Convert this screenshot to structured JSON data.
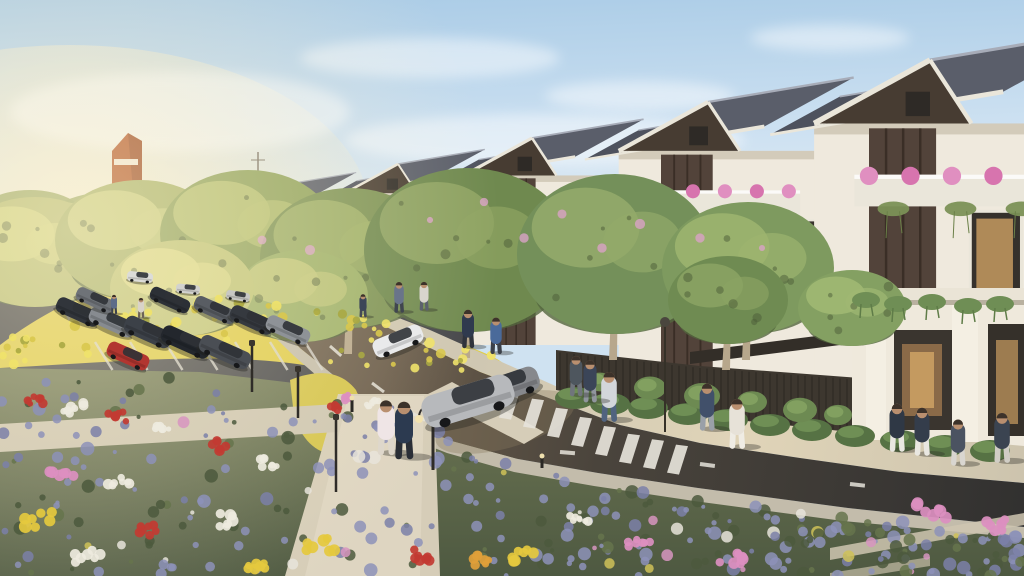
{
  "scene": {
    "description": "Photorealistic architectural rendering of a new residential neighborhood: a receding row of modern gabled townhouses with pink balcony flowers, tree-lined street with cars and pedestrians, parking lot, yellow flower bushes and a lavender flower garden in the foreground, late-afternoon sunlight from the left.",
    "type": "architectural-render"
  },
  "palette": {
    "sky_top": "#a9cbe6",
    "sky_mid": "#cfe2f2",
    "sky_low": "#eef2f0",
    "sun_glow": "#fbf3da",
    "roof": "#5a5e6a",
    "roof_dark": "#4e525e",
    "roof_line": "#a7acb8",
    "fascia": "#eae6da",
    "gable": "#473c32",
    "wall": "#efe9dd",
    "wall_shade": "#c9c0ae",
    "wood": "#52433a",
    "wood_dark": "#3a2e26",
    "glass": "#35312c",
    "glass_warm": "#c49a60",
    "balcony_pink": "#e08fc0",
    "pink_deep": "#d774ae",
    "vine": "#7b9156",
    "vine_dark": "#6b8048",
    "flower_yellow": "#dfcc48",
    "yellow_hi": "#f0e26a",
    "yellow_dk": "#aaa844",
    "lavender": "#8d92b8",
    "lavender_hi": "#a7abc9",
    "garden_dark": "#4c593d",
    "garden_mid": "#5d6b48",
    "road_warm": "#6a5c4b",
    "road_mid": "#4a443c",
    "road_dark": "#323130",
    "lot_asphalt": "#45464a",
    "marking": "#e6e3da",
    "path": "#d6cdb8",
    "path_hi": "#e2dac6",
    "sidewalk": "#c3bcab",
    "plaza": "#d4ccb8",
    "plaza_sun": "#e0d4b8",
    "fence": "#3d372f",
    "pergola": "#332e28",
    "hedge": "#567244",
    "hedge_hi": "#6f8f55",
    "orange_tower": "#b4582a",
    "orange_dark": "#8a3f1e",
    "trunk": "#b7a78c",
    "skin": "#b98f6f",
    "shadow": "#2c2a26",
    "blossom": "#d9a3c6"
  },
  "clouds": [
    [
      430,
      58,
      130,
      20
    ],
    [
      640,
      96,
      95,
      15
    ],
    [
      830,
      38,
      80,
      13
    ],
    [
      180,
      112,
      170,
      40
    ],
    [
      545,
      140,
      200,
      26
    ]
  ],
  "orange_tower": {
    "x": 112,
    "y": 133,
    "w": 30,
    "h": 68
  },
  "distant_houses": [
    [
      62,
      206,
      13
    ],
    [
      86,
      202,
      14
    ],
    [
      111,
      198,
      15
    ],
    [
      137,
      194,
      16
    ],
    [
      165,
      190,
      17
    ],
    [
      195,
      186,
      18
    ]
  ],
  "houses": [
    [
      225,
      197,
      34,
      278
    ],
    [
      288,
      184,
      44,
      295
    ],
    [
      398,
      164,
      56,
      315
    ],
    [
      532,
      138,
      72,
      345
    ],
    [
      708,
      102,
      94,
      402
    ],
    [
      930,
      60,
      122,
      448
    ]
  ],
  "trees": [
    [
      35,
      252,
      78,
      55,
      "#b9bf74",
      "#d3d583",
      0
    ],
    [
      140,
      240,
      85,
      60,
      "#a9b46a",
      "#ccd083",
      0
    ],
    [
      248,
      234,
      88,
      64,
      "#90a35c",
      "#b8c273",
      0
    ],
    [
      350,
      258,
      90,
      70,
      "#7d9355",
      "#9fb068",
      1
    ],
    [
      468,
      250,
      104,
      82,
      "#6f894f",
      "#8fa463",
      1
    ],
    [
      615,
      254,
      98,
      80,
      "#74905a",
      "#93aa6a",
      1
    ],
    [
      748,
      268,
      86,
      66,
      "#7e9a5f",
      "#9cb46f",
      1
    ],
    [
      852,
      308,
      54,
      38,
      "#84a062",
      "#a0b873",
      0
    ],
    [
      302,
      296,
      66,
      46,
      "#9cb067",
      "#c2c87a",
      0
    ],
    [
      182,
      288,
      72,
      48,
      "#c0c577",
      "#ddda8a",
      0
    ],
    [
      728,
      300,
      60,
      44,
      "#6f8b52",
      "#8aa263",
      1
    ]
  ],
  "blossoms": [
    [
      430,
      220
    ],
    [
      484,
      202
    ],
    [
      524,
      238
    ],
    [
      562,
      214
    ],
    [
      640,
      224
    ],
    [
      602,
      248
    ],
    [
      700,
      238
    ],
    [
      762,
      248
    ],
    [
      310,
      250
    ],
    [
      262,
      240
    ]
  ],
  "cars_road": [
    [
      398,
      341,
      52,
      19,
      -22,
      "#e9eaeb"
    ],
    [
      509,
      386,
      62,
      25,
      -19,
      "#86888c"
    ],
    [
      468,
      401,
      94,
      33,
      -17,
      "#b7b9bc"
    ]
  ],
  "cars_parked": [
    [
      78,
      312,
      46,
      16,
      24,
      "#31353b"
    ],
    [
      112,
      322,
      48,
      17,
      24,
      "#878b90"
    ],
    [
      148,
      332,
      50,
      18,
      24,
      "#3c4148"
    ],
    [
      186,
      342,
      52,
      18,
      24,
      "#23272d"
    ],
    [
      225,
      352,
      54,
      18,
      24,
      "#4a4e54"
    ],
    [
      128,
      356,
      44,
      16,
      24,
      "#b23630"
    ],
    [
      95,
      300,
      40,
      14,
      24,
      "#6f7378"
    ],
    [
      170,
      300,
      42,
      14,
      24,
      "#2c3036"
    ],
    [
      215,
      310,
      44,
      15,
      24,
      "#595d63"
    ],
    [
      252,
      320,
      46,
      16,
      24,
      "#35393f"
    ],
    [
      288,
      330,
      46,
      16,
      24,
      "#8e9297"
    ],
    [
      140,
      277,
      26,
      10,
      6,
      "#dcdcd8"
    ],
    [
      188,
      289,
      24,
      9,
      6,
      "#d2d2cf"
    ],
    [
      238,
      296,
      24,
      9,
      10,
      "#c8c8c4"
    ]
  ],
  "people": [
    [
      114,
      313,
      20,
      "#5d6c88",
      "#3c414c"
    ],
    [
      141,
      317,
      21,
      "#d9d3c9",
      "#6d6257"
    ],
    [
      386,
      452,
      57,
      "#efe5e6",
      "#ded7cb"
    ],
    [
      404,
      456,
      60,
      "#2c3a50",
      "#2a2e36"
    ],
    [
      609,
      419,
      52,
      "#d3d6da",
      "#50637f"
    ],
    [
      707,
      428,
      49,
      "#41506a",
      "#9aa0a8"
    ],
    [
      737,
      446,
      52,
      "#e7e2d8",
      "#efece4"
    ],
    [
      399,
      311,
      32,
      "#69748a",
      "#40464f"
    ],
    [
      424,
      309,
      30,
      "#d9d5cd",
      "#5c616c"
    ],
    [
      468,
      346,
      40,
      "#2f3a4e",
      "#30343c"
    ],
    [
      496,
      352,
      38,
      "#4a6a9a",
      "#3b4049"
    ],
    [
      590,
      400,
      44,
      "#3b4558",
      "#90959d"
    ],
    [
      897,
      449,
      50,
      "#2f3845",
      "#e9e7e1"
    ],
    [
      922,
      453,
      50,
      "#343d4b",
      "#e9e7e1"
    ],
    [
      958,
      463,
      48,
      "#4b5361",
      "#d9d6d0"
    ],
    [
      1002,
      460,
      52,
      "#3b4451",
      "#d0cdc5"
    ],
    [
      363,
      316,
      24,
      "#3c4658",
      "#454a55"
    ],
    [
      576,
      394,
      42,
      "#4e565e",
      "#70757c"
    ]
  ],
  "lamps": [
    [
      "post",
      336,
      492,
      72
    ],
    [
      "twin",
      433,
      470,
      60
    ],
    [
      "sign",
      665,
      432,
      106
    ],
    [
      "post",
      252,
      392,
      46
    ],
    [
      "post",
      298,
      418,
      46
    ],
    [
      "bollard",
      352,
      412,
      14
    ],
    [
      "bollard",
      542,
      468,
      12
    ]
  ],
  "hedges": [
    [
      575,
      398
    ],
    [
      610,
      404
    ],
    [
      648,
      408
    ],
    [
      688,
      414
    ],
    [
      728,
      420
    ],
    [
      770,
      425
    ],
    [
      812,
      430
    ],
    [
      855,
      436
    ],
    [
      900,
      441
    ],
    [
      945,
      446
    ],
    [
      990,
      451
    ]
  ],
  "fence_vines": [
    [
      600,
      382,
      13
    ],
    [
      650,
      388,
      16
    ],
    [
      702,
      396,
      18
    ],
    [
      752,
      402,
      15
    ],
    [
      800,
      410,
      17
    ],
    [
      838,
      415,
      14
    ]
  ],
  "hanging_plants": [
    [
      866,
      300
    ],
    [
      898,
      304
    ],
    [
      932,
      302
    ],
    [
      968,
      306
    ],
    [
      1000,
      304
    ]
  ],
  "flower_clusters": [
    [
      35,
      400,
      10,
      "#c23b32"
    ],
    [
      75,
      408,
      12,
      "#eeeade"
    ],
    [
      118,
      416,
      11,
      "#c23b32"
    ],
    [
      160,
      430,
      9,
      "#eeeade"
    ],
    [
      215,
      446,
      12,
      "#c23b32"
    ],
    [
      268,
      462,
      10,
      "#eeeade"
    ],
    [
      60,
      470,
      14,
      "#dc8fc0"
    ],
    [
      120,
      480,
      12,
      "#eeeade"
    ],
    [
      40,
      520,
      16,
      "#e5c93e"
    ],
    [
      150,
      530,
      13,
      "#c23b32"
    ],
    [
      230,
      520,
      14,
      "#eeeade"
    ],
    [
      320,
      545,
      16,
      "#e5c93e"
    ],
    [
      420,
      555,
      13,
      "#c23b32"
    ],
    [
      520,
      556,
      14,
      "#e5c93e"
    ],
    [
      640,
      545,
      12,
      "#dc8fc0"
    ],
    [
      730,
      558,
      14,
      "#dc8fc0"
    ],
    [
      930,
      510,
      16,
      "#dc8fc0"
    ],
    [
      995,
      525,
      13,
      "#dc8fc0"
    ],
    [
      580,
      520,
      10,
      "#eeeade"
    ],
    [
      90,
      556,
      15,
      "#eeeade"
    ],
    [
      260,
      565,
      12,
      "#e5c93e"
    ],
    [
      350,
      398,
      8,
      "#dc8fc0"
    ],
    [
      372,
      404,
      7,
      "#eeeade"
    ],
    [
      335,
      408,
      7,
      "#c23b32"
    ],
    [
      480,
      560,
      12,
      "#dfa03a"
    ]
  ],
  "markings": {
    "crosswalk": {
      "x0": 508,
      "count": 8,
      "step": 24
    },
    "mini_crosswalk": {
      "x0": 330,
      "count": 4,
      "step": 10,
      "y": 302
    },
    "dashes_upper": [
      [
        287,
        303
      ],
      [
        330,
        346
      ],
      [
        372,
        383
      ],
      [
        412,
        413
      ],
      [
        450,
        434
      ]
    ],
    "dashes_lower": [
      [
        560,
        452
      ],
      [
        700,
        464
      ],
      [
        850,
        484
      ],
      [
        1000,
        501
      ]
    ],
    "lot_rows": [
      {
        "x0": 58,
        "y0": 298,
        "n": 7,
        "dx": 29,
        "len": 27,
        "ang": 62
      },
      {
        "x0": 95,
        "y0": 342,
        "n": 7,
        "dx": 35,
        "len": 33,
        "ang": 58
      }
    ]
  },
  "road_top_edge": [
    [
      322,
      296
    ],
    [
      480,
      372
    ],
    [
      620,
      425
    ],
    [
      700,
      443
    ],
    [
      800,
      458
    ],
    [
      900,
      472
    ],
    [
      1024,
      483
    ]
  ],
  "road_bottom_edge": [
    [
      253,
      296
    ],
    [
      300,
      348
    ],
    [
      352,
      390
    ],
    [
      402,
      421
    ],
    [
      452,
      441
    ],
    [
      518,
      459
    ],
    [
      598,
      473
    ],
    [
      698,
      488
    ],
    [
      848,
      508
    ],
    [
      1024,
      527
    ]
  ],
  "fence_top": [
    [
      556,
      350
    ],
    [
      700,
      366
    ],
    [
      860,
      378
    ]
  ],
  "fence_bottom": [
    [
      556,
      390
    ],
    [
      700,
      416
    ],
    [
      860,
      433
    ]
  ],
  "garden_top": [
    [
      0,
      370
    ],
    [
      200,
      374
    ],
    [
      320,
      388
    ],
    [
      400,
      404
    ],
    [
      460,
      436
    ],
    [
      520,
      462
    ],
    [
      600,
      478
    ],
    [
      700,
      492
    ],
    [
      850,
      512
    ],
    [
      1024,
      530
    ]
  ],
  "yellow_zone": {
    "top": [
      [
        0,
        340
      ],
      [
        120,
        292
      ],
      [
        240,
        292
      ],
      [
        360,
        316
      ],
      [
        500,
        356
      ]
    ],
    "bot": [
      [
        0,
        366
      ],
      [
        120,
        352
      ],
      [
        240,
        346
      ],
      [
        360,
        372
      ],
      [
        500,
        372
      ]
    ]
  }
}
